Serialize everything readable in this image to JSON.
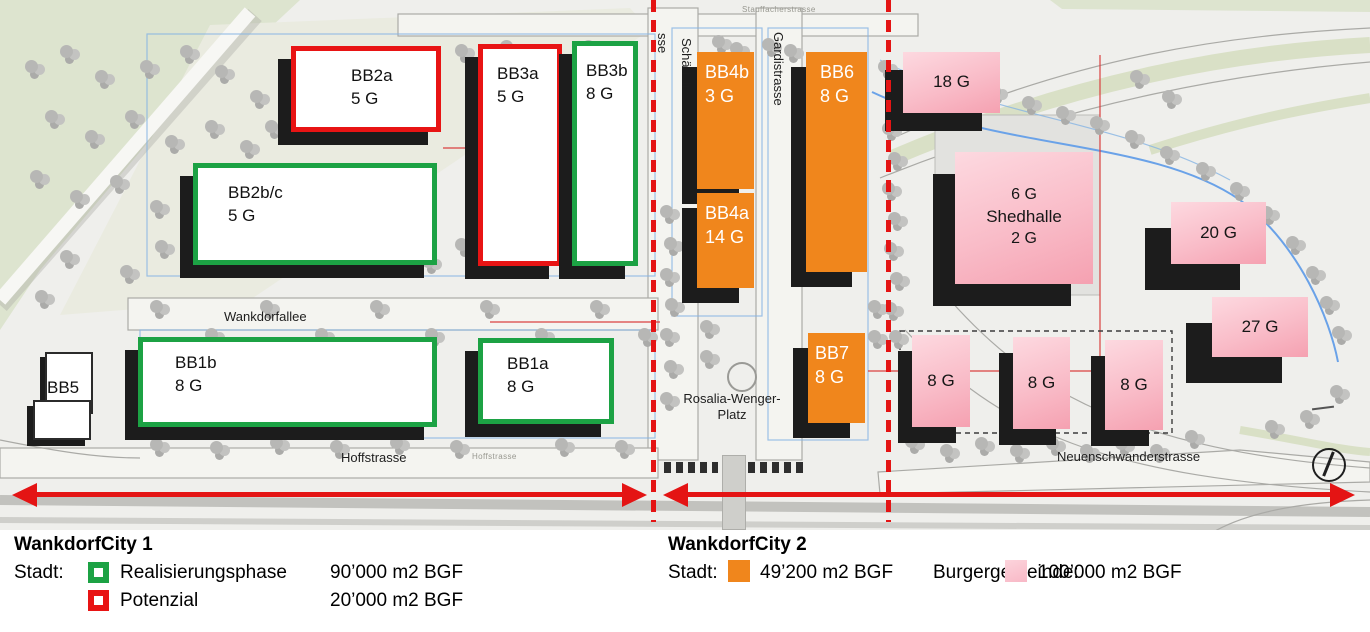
{
  "map": {
    "street_labels": {
      "stauffacherstrasse": "Stauffacherstrasse",
      "schaedelin_fragment": "sse",
      "schaedelinstrasse": "Schädelinstra",
      "gardistrasse": "Gardistrasse",
      "wankdorfallee": "Wankdorfallee",
      "hoffstrasse": "Hoffstrasse",
      "hoffstrasse_small": "Hoffstrasse",
      "neuenschwanderstrasse": "Neuenschwanderstrasse",
      "rosalia_line1": "Rosalia-Wenger-",
      "rosalia_line2": "Platz"
    },
    "buildings": {
      "bb5": {
        "name": "BB5"
      },
      "wc1": [
        {
          "id": "BB2a",
          "floors": "5 G",
          "status": "Potenzial"
        },
        {
          "id": "BB2b/c",
          "floors": "5 G",
          "status": "Realisierungsphase"
        },
        {
          "id": "BB3a",
          "floors": "5 G",
          "status": "Potenzial"
        },
        {
          "id": "BB3b",
          "floors": "8 G",
          "status": "Realisierungsphase"
        },
        {
          "id": "BB1b",
          "floors": "8 G",
          "status": "Realisierungsphase"
        },
        {
          "id": "BB1a",
          "floors": "8 G",
          "status": "Realisierungsphase"
        }
      ],
      "wc2_stadt": [
        {
          "id": "BB4b",
          "floors": "3 G"
        },
        {
          "id": "BB4a",
          "floors": "14 G"
        },
        {
          "id": "BB6",
          "floors": "8 G"
        },
        {
          "id": "BB7",
          "floors": "8 G"
        }
      ],
      "wc2_burgergemeinde": [
        {
          "label": "18 G"
        },
        {
          "top": "6 G",
          "name": "Shedhalle",
          "bottom": "2 G"
        },
        {
          "label": "20 G"
        },
        {
          "label": "27 G"
        },
        {
          "label": "8 G"
        },
        {
          "label": "8 G"
        },
        {
          "label": "8 G"
        }
      ]
    }
  },
  "legend": {
    "wc1": {
      "title": "WankdorfCity 1",
      "owner_label": "Stadt:",
      "rows": [
        {
          "label": "Realisierungsphase",
          "value": "90’000 m2  BGF"
        },
        {
          "label": "Potenzial",
          "value": "20’000 m2 BGF"
        }
      ]
    },
    "wc2": {
      "title": "WankdorfCity 2",
      "owner_label": "Stadt:",
      "stadt_value": "49’200 m2  BGF",
      "burgergemeinde_label": "Burgergemeinde:",
      "burgergemeinde_value": "100’000 m2 BGF"
    }
  },
  "colors": {
    "realisierung_green": "#1ca244",
    "potenzial_red": "#e81414",
    "stadt_orange": "#f0861c",
    "pink_light": "#fdd9e0",
    "pink_dark": "#f5a1b1",
    "divider_red": "#e41414"
  }
}
